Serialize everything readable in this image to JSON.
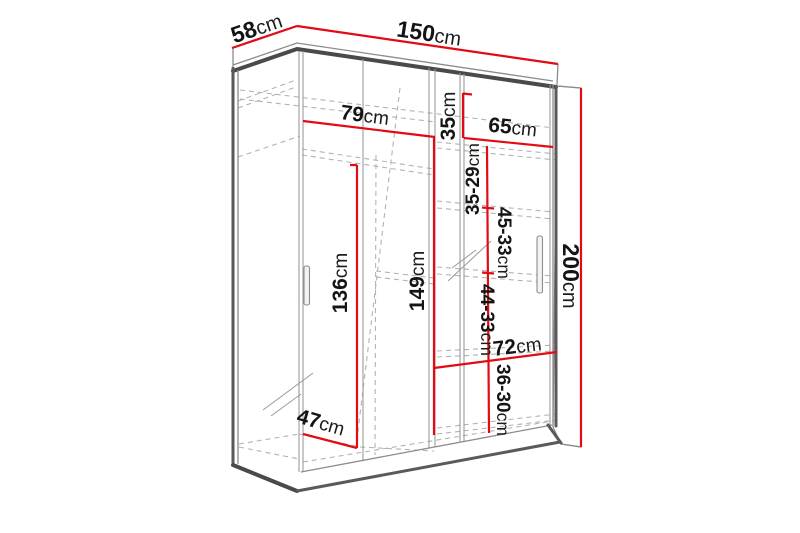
{
  "diagram": {
    "subject": "sliding-door wardrobe with dimension lines",
    "unit": "cm",
    "accent_color": "#e30b13",
    "line_color": "#4a4a4a",
    "dimensions": {
      "depth_top": {
        "value": "58",
        "unit": "cm"
      },
      "width_top": {
        "value": "150",
        "unit": "cm"
      },
      "height_right": {
        "value": "200",
        "unit": "cm"
      },
      "left_section_width": {
        "value": "79",
        "unit": "cm"
      },
      "top_shelf_height": {
        "value": "35",
        "unit": "cm"
      },
      "right_width_top": {
        "value": "65",
        "unit": "cm"
      },
      "shelf_gap_1": {
        "value": "35-29",
        "unit": "cm"
      },
      "shelf_gap_2": {
        "value": "45-33",
        "unit": "cm"
      },
      "center_height": {
        "value": "149",
        "unit": "cm"
      },
      "hanging_height": {
        "value": "136",
        "unit": "cm"
      },
      "shelf_gap_3": {
        "value": "44-33",
        "unit": "cm"
      },
      "right_width_bottom": {
        "value": "72",
        "unit": "cm"
      },
      "shelf_gap_4": {
        "value": "36-30",
        "unit": "cm"
      },
      "interior_depth": {
        "value": "47",
        "unit": "cm"
      }
    }
  }
}
